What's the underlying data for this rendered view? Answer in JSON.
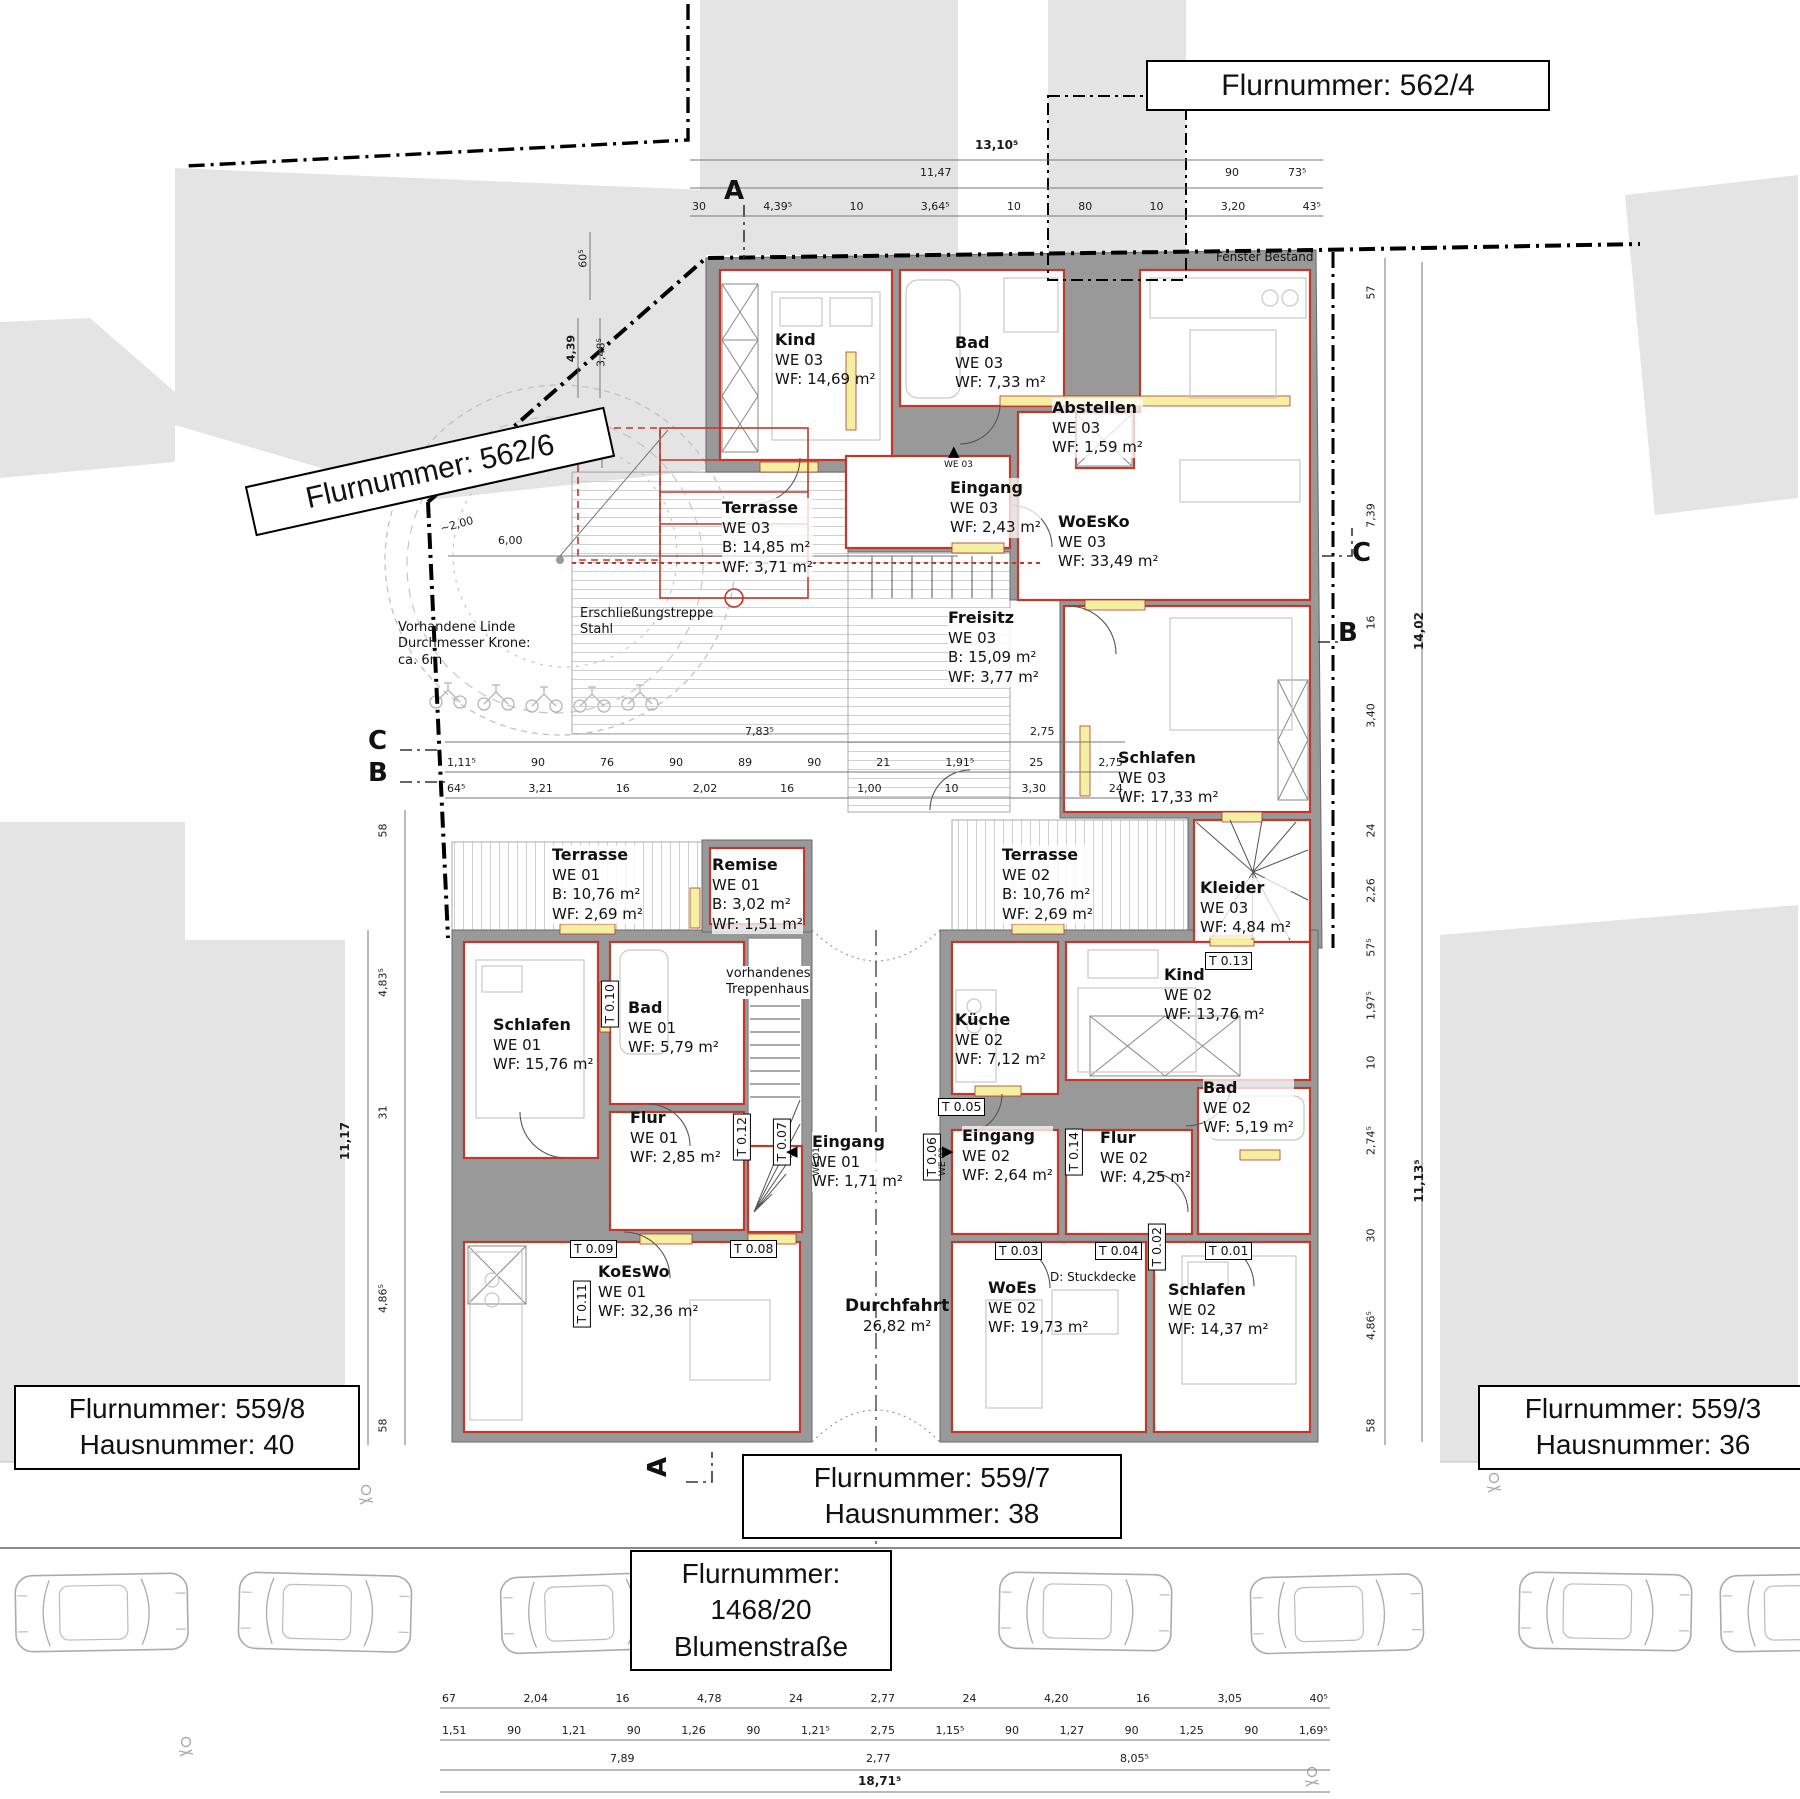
{
  "parcel_labels": {
    "p562_4": "Flurnummer: 562/4",
    "p562_6": "Flurnummer: 562/6",
    "p559_8_l1": "Flurnummer: 559/8",
    "p559_8_l2": "Hausnummer: 40",
    "p559_3_l1": "Flurnummer: 559/3",
    "p559_3_l2": "Hausnummer: 36",
    "p559_7_l1": "Flurnummer: 559/7",
    "p559_7_l2": "Hausnummer: 38",
    "street_l1": "Flurnummer:",
    "street_l2": "1468/20",
    "street_l3": "Blumenstraße"
  },
  "rooms": {
    "kind3": {
      "name": "Kind",
      "lines": "WE 03\nWF: 14,69 m²"
    },
    "bad3": {
      "name": "Bad",
      "lines": "WE 03\nWF: 7,33 m²"
    },
    "abstellen": {
      "name": "Abstellen",
      "lines": "WE 03\nWF: 1,59 m²"
    },
    "eingang3": {
      "name": "Eingang",
      "lines": "WE 03\nWF: 2,43 m²"
    },
    "woesko": {
      "name": "WoEsKo",
      "lines": "WE 03\nWF: 33,49 m²"
    },
    "terrasse3": {
      "name": "Terrasse",
      "lines": "WE 03\nB:  14,85 m²\nWF: 3,71 m²"
    },
    "freisitz": {
      "name": "Freisitz",
      "lines": "WE 03\nB:  15,09 m²\nWF: 3,77 m²"
    },
    "schlafen3": {
      "name": "Schlafen",
      "lines": "WE 03\nWF: 17,33 m²"
    },
    "kleider": {
      "name": "Kleider",
      "lines": "WE 03\nWF: 4,84 m²"
    },
    "terrasse1": {
      "name": "Terrasse",
      "lines": "WE 01\nB:  10,76 m²\nWF: 2,69 m²"
    },
    "remise": {
      "name": "Remise",
      "lines": "WE 01\nB:  3,02 m²\nWF: 1,51 m²"
    },
    "schlafen1": {
      "name": "Schlafen",
      "lines": "WE 01\nWF: 15,76 m²"
    },
    "bad1": {
      "name": "Bad",
      "lines": "WE 01\nWF: 5,79 m²"
    },
    "flur1": {
      "name": "Flur",
      "lines": "WE 01\nWF: 2,85 m²"
    },
    "eingang1": {
      "name": "Eingang",
      "lines": "WE 01\nWF: 1,71 m²"
    },
    "koeswo": {
      "name": "KoEsWo",
      "lines": "WE 01\nWF: 32,36 m²"
    },
    "terrasse2": {
      "name": "Terrasse",
      "lines": "WE 02\nB:  10,76 m²\nWF: 2,69 m²"
    },
    "kueche": {
      "name": "Küche",
      "lines": "WE 02\nWF: 7,12 m²"
    },
    "kind2": {
      "name": "Kind",
      "lines": "WE 02\nWF: 13,76 m²"
    },
    "bad2": {
      "name": "Bad",
      "lines": "WE 02\nWF: 5,19 m²"
    },
    "eingang2": {
      "name": "Eingang",
      "lines": "WE 02\nWF: 2,64 m²"
    },
    "flur2": {
      "name": "Flur",
      "lines": "WE 02\nWF: 4,25 m²"
    },
    "woes": {
      "name": "WoEs",
      "lines": "WE 02\nWF: 19,73 m²"
    },
    "schlafen2": {
      "name": "Schlafen",
      "lines": "WE 02\nWF: 14,37 m²"
    },
    "durchfahrt": {
      "name": "Durchfahrt",
      "lines": "26,82 m²"
    }
  },
  "annotations": {
    "fenster": "Fenster Bestand",
    "linde": "Vorhandene Linde\nDurchmesser Krone:\nca. 6m",
    "stahltreppe": "Erschließungstreppe\nStahl",
    "treppenhaus": "vorhandenes\nTreppenhaus",
    "stuckdecke": "D: Stuckdecke"
  },
  "tags": {
    "t01": "T 0.01",
    "t02": "T 0.02",
    "t03": "T 0.03",
    "t04": "T 0.04",
    "t05": "T 0.05",
    "t06": "T 0.06",
    "t07": "T 0.07",
    "t08": "T 0.08",
    "t09": "T 0.09",
    "t10": "T 0.10",
    "t11": "T 0.11",
    "t12": "T 0.12",
    "t13": "T 0.13",
    "t14": "T 0.14"
  },
  "entry": {
    "we01": "WE 01",
    "we02": "WE 02",
    "we03": "WE 03"
  },
  "sections": {
    "a": "A",
    "b": "B",
    "c": "C"
  },
  "dims": {
    "top_total": "13,10⁵",
    "top_row2": [
      "11,47",
      "90",
      "73⁵"
    ],
    "top_row3": [
      "30",
      "4,39⁵",
      "10",
      "3,64⁵",
      "10",
      "80",
      "10",
      "3,20",
      "43⁵"
    ],
    "mid_row1": [
      "7,83⁵",
      "2,75"
    ],
    "mid_row2": [
      "1,11⁵",
      "90",
      "76",
      "90",
      "89",
      "90",
      "21",
      "1,91⁵",
      "25",
      "2,75"
    ],
    "mid_row3": [
      "64⁵",
      "3,21",
      "16",
      "2,02",
      "16",
      "1,00",
      "10",
      "3,30",
      "24"
    ],
    "bottom_row1": [
      "67",
      "2,04",
      "16",
      "4,78",
      "24",
      "2,77",
      "24",
      "4,20",
      "16",
      "3,05",
      "40⁵"
    ],
    "bottom_row2": [
      "1,51",
      "90",
      "1,21",
      "90",
      "1,26",
      "90",
      "1,21⁵",
      "2,75",
      "1,15⁵",
      "90",
      "1,27",
      "90",
      "1,25",
      "90",
      "1,69⁵"
    ],
    "bottom_row3": [
      "7,89",
      "2,77",
      "8,05⁵"
    ],
    "bottom_total": "18,71⁵",
    "left_col": [
      "58",
      "4,83⁵",
      "31",
      "4,86⁵",
      "58"
    ],
    "left_total": "11,17",
    "right_col": [
      "57",
      "7,39",
      "16",
      "3,40",
      "24",
      "2,26",
      "57⁵",
      "1,97⁵",
      "10",
      "2,74⁵",
      "30",
      "4,86⁵",
      "58"
    ],
    "right_total_upper": "14,02",
    "right_total_lower": "11,13⁵",
    "tree": [
      "60⁵",
      "4,39",
      "3,48⁵",
      "30",
      "~2,00",
      "~2,00",
      "6,00"
    ]
  },
  "colors": {
    "wall_gray": "#999999",
    "room_outline_red": "#c0392b",
    "window_yellow": "#f5efa2",
    "parcel_gray": "#e4e4e4",
    "boundary_black": "#000000"
  }
}
